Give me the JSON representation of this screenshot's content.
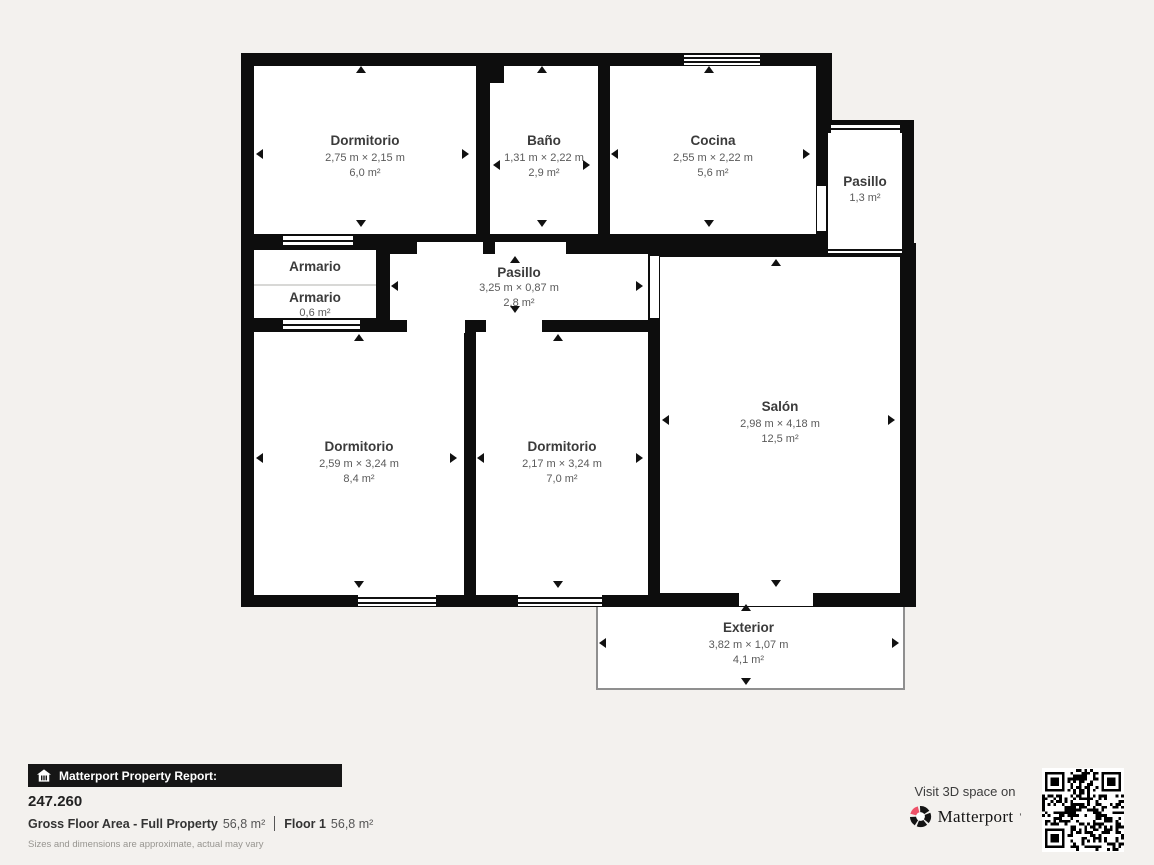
{
  "rooms": {
    "dorm_tl": {
      "name": "Dormitorio",
      "dims": "2,75 m × 2,15 m",
      "area": "6,0 m²"
    },
    "bano": {
      "name": "Baño",
      "dims": "1,31 m × 2,22 m",
      "area": "2,9 m²"
    },
    "cocina": {
      "name": "Cocina",
      "dims": "2,55 m × 2,22 m",
      "area": "5,6 m²"
    },
    "pasillo_right": {
      "name": "Pasillo",
      "area": "1,3 m²"
    },
    "armario_top": {
      "name": "Armario"
    },
    "armario_bottom": {
      "name": "Armario",
      "area": "0,6 m²"
    },
    "pasillo_center": {
      "name": "Pasillo",
      "dims": "3,25 m × 0,87 m",
      "area": "2,8 m²"
    },
    "salon": {
      "name": "Salón",
      "dims": "2,98 m × 4,18 m",
      "area": "12,5 m²"
    },
    "dorm_bl": {
      "name": "Dormitorio",
      "dims": "2,59 m × 3,24 m",
      "area": "8,4 m²"
    },
    "dorm_bc": {
      "name": "Dormitorio",
      "dims": "2,17 m × 3,24 m",
      "area": "7,0 m²"
    },
    "exterior": {
      "name": "Exterior",
      "dims": "3,82 m × 1,07 m",
      "area": "4,1 m²"
    }
  },
  "report": {
    "bar_title": "Matterport Property Report:",
    "reference": "247.260",
    "gfa_label": "Gross Floor Area - Full Property",
    "gfa_value": "56,8 m²",
    "floor_label": "Floor 1",
    "floor_value": "56,8 m²",
    "disclaimer": "Sizes and dimensions are approximate, actual may vary"
  },
  "promo": {
    "visit_text": "Visit 3D space on",
    "brand": "Matterport"
  },
  "colors": {
    "wall": "#0d0d0d",
    "room_fill": "#ffffff",
    "background": "#f3f1ee",
    "brand_accent": "#ee5168"
  }
}
